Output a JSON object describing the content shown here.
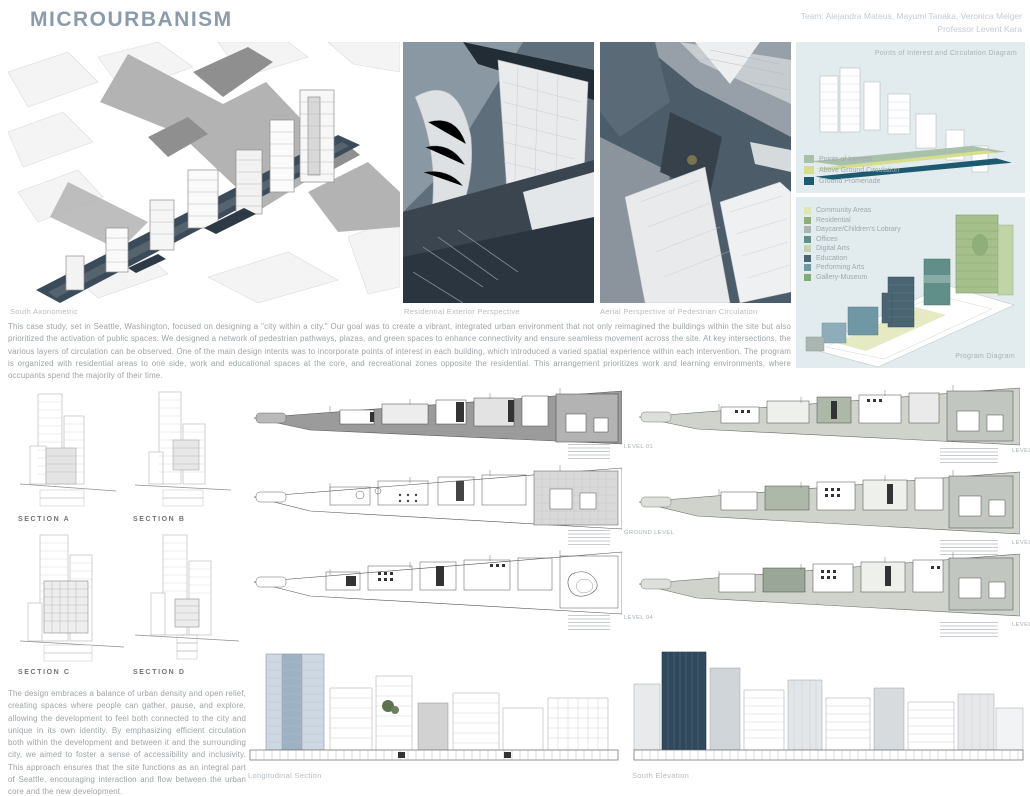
{
  "header": {
    "title": "MICROURBANISM",
    "credits_line1": "Team: Alejandra Mateus, Mayumi Tanaka, Veronica Melger",
    "credits_line2": "Professor Levent Kara"
  },
  "colors": {
    "title": "#8c9bab",
    "panel_background": "#e2ebee",
    "ground_promenade_teal": "#1d5a70",
    "site_navy": "#3c4b59"
  },
  "captions": {
    "axonometric": "South Axonometric",
    "residential_perspective": "Residential Exterior Perspective",
    "aerial_perspective": "Aerial Perspective of Pedestrian Circulation",
    "circulation_diagram": "Points of Interest and Circulation Diagram",
    "program_diagram": "Program Diagram",
    "longitudinal_section": "Longitudinal Section",
    "south_elevation": "South Elevation"
  },
  "intro_paragraph": "This case study, set in Seattle, Washington, focused on designing a \"city within a city.\" Our goal was to create a vibrant, integrated urban environment that not only reimagined the buildings within the site but also prioritized the activation of public spaces. We designed a network of pedestrian pathways, plazas, and green spaces to enhance connectivity and ensure seamless movement across the site. At key intersections, the various layers of circulation can be observed. One of the main design intents was to incorporate points of interest in each building, which introduced a varied spatial experience within each intervention. The program is organized with residential areas to one side, work and educational spaces at the core, and recreational zones opposite the residential. This arrangement prioritizes work and learning environments, where occupants spend the majority of their time.",
  "design_paragraph": "The design embraces a balance of urban density and open relief, creating spaces where people can gather, pause, and explore, allowing the development to feel both connected to the city and unique in its own identity. By emphasizing efficient circulation both within the development and between it and the surrounding city, we aimed to foster a sense of accessibility and inclusivity. This approach ensures that the site functions as an integral part of Seattle, encouraging interaction and flow between the urban core and the new development.",
  "circulation_legend": [
    {
      "label": "Points of Interest",
      "color": "#a9c0ab"
    },
    {
      "label": "Above Ground Circulation",
      "color": "#d5de8d"
    },
    {
      "label": "Ground Promenade",
      "color": "#1d5a70"
    }
  ],
  "program_legend": [
    {
      "label": "Community Areas",
      "color": "#dfe5b4"
    },
    {
      "label": "Residential",
      "color": "#8fae79"
    },
    {
      "label": "Daycare/Children's Lobrary",
      "color": "#a9b6b2"
    },
    {
      "label": "Offices",
      "color": "#5f8f88"
    },
    {
      "label": "Digital Arts",
      "color": "#c8d2b3"
    },
    {
      "label": "Education",
      "color": "#4a6472"
    },
    {
      "label": "Performing Arts",
      "color": "#7097a4"
    },
    {
      "label": "Gallery-Museum",
      "color": "#82aa7a"
    }
  ],
  "sections": [
    {
      "label": "SECTION A"
    },
    {
      "label": "SECTION B"
    },
    {
      "label": "SECTION C"
    },
    {
      "label": "SECTION D"
    }
  ],
  "plans": [
    {
      "label": "LEVEL 01"
    },
    {
      "label": "LEVEL 02"
    },
    {
      "label": "GROUND LEVEL"
    },
    {
      "label": "LEVEL 03"
    },
    {
      "label": "LEVEL 04"
    },
    {
      "label": "LEVEL 05"
    }
  ]
}
